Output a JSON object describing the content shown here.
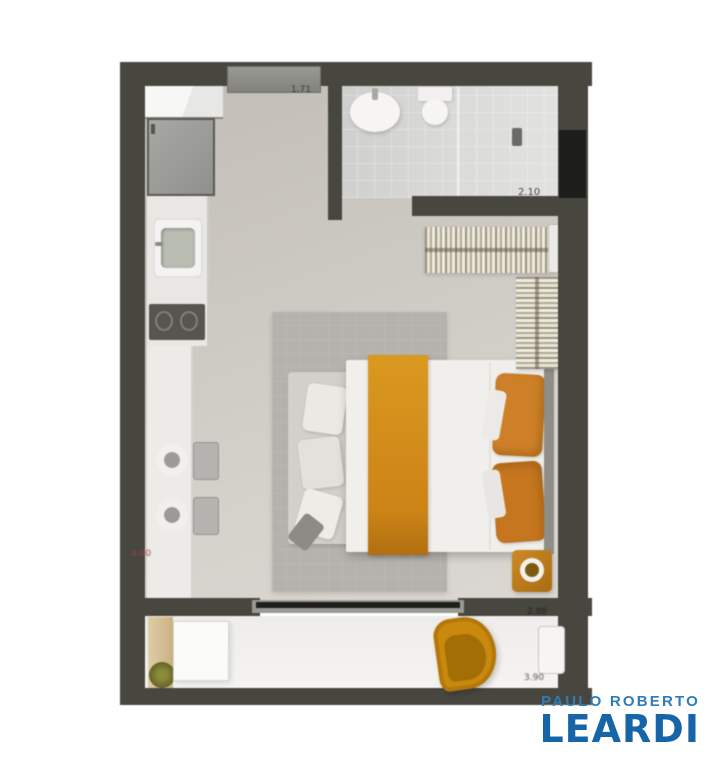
{
  "floorplan": {
    "type": "studio-apartment-top-view-floor-plan",
    "dimension_labels": {
      "entry": "1.71",
      "bathroom": "2.10",
      "kitchen": "4.00",
      "balcony_depth": "2.88",
      "balcony_length": "3.90"
    },
    "colors": {
      "wall": "#47463f",
      "main_floor": "#ccc8c2",
      "bathroom_floor": "#d9d9d7",
      "balcony_floor": "#f1f0ee",
      "rug": "#b5b2ad",
      "accent_orange": "#cf861c",
      "wood": "#d4c098"
    }
  },
  "branding": {
    "line1": "PAULO ROBERTO",
    "line2": "LEARDI",
    "line1_color": "#2e7cb8",
    "line2_color": "#1565a8"
  }
}
